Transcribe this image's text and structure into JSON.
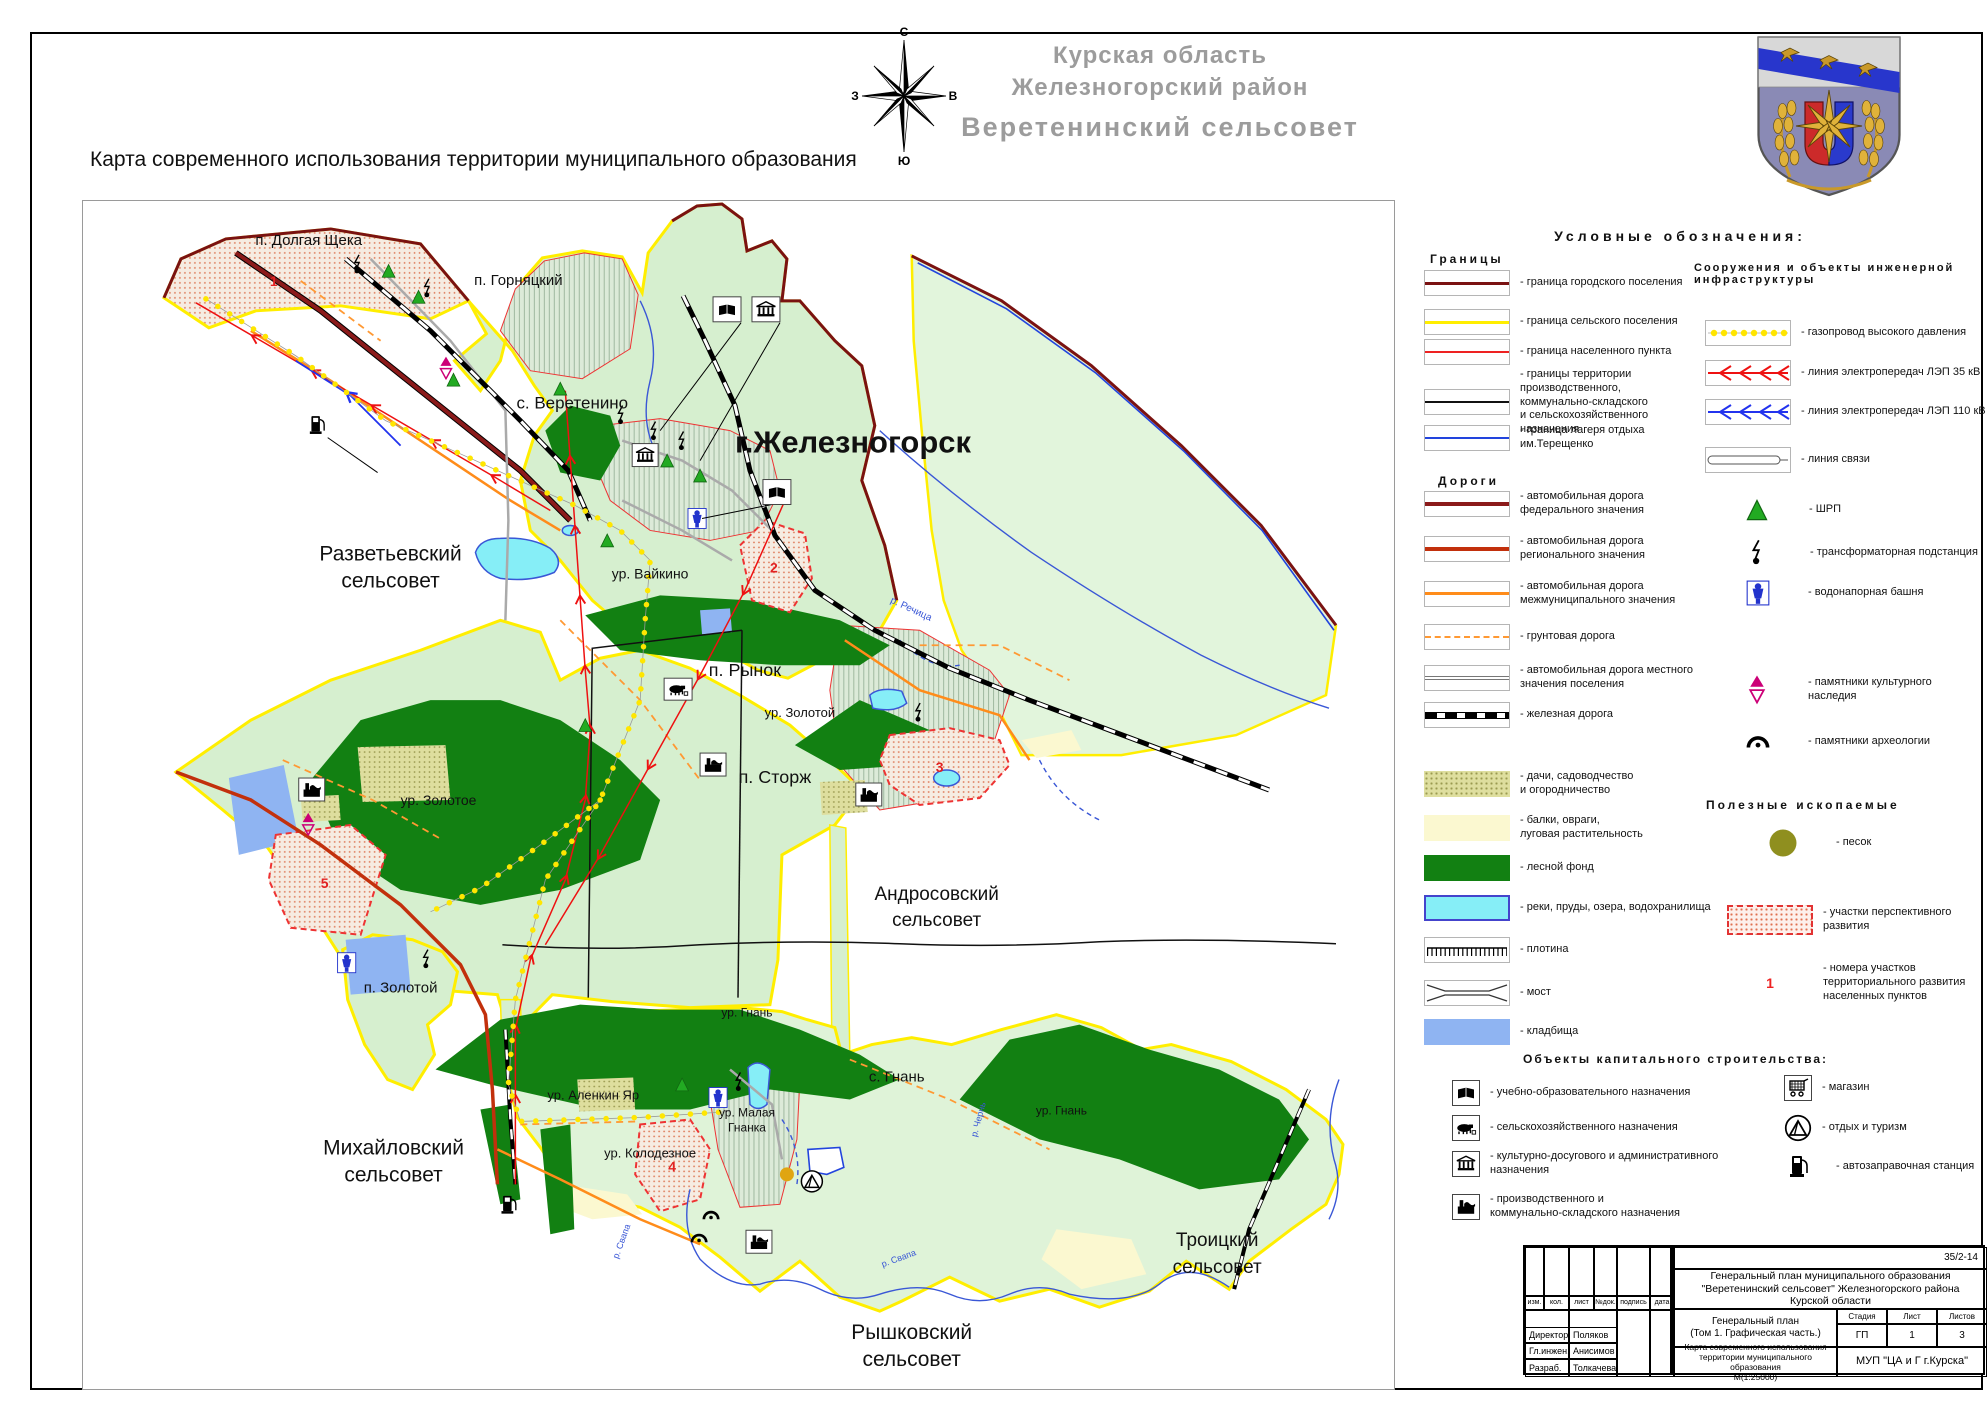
{
  "page": {
    "main_title": "Карта современного использования территории муниципального образования",
    "region_line1": "Курская область",
    "region_line2": "Железногорский  район",
    "region_line3": "Веретенинский  сельсовет",
    "compass": {
      "n": "С",
      "s": "Ю",
      "w": "З",
      "e": "В"
    }
  },
  "map": {
    "labels": {
      "dolgaya": "п. Долгая Щека",
      "gornyatsky": "п. Горняцкий",
      "veretenino": "с. Веретенино",
      "zheleznogorsk": "г.Железногорск",
      "razvet1": "Разветьевский",
      "razvet2": "сельсовет",
      "vaikino": "ур. Вайкино",
      "rynok": "п. Рынок",
      "ur_zolotoy": "ур. Золотой",
      "ur_zolotoye": "ур. Золотое",
      "storzh": "п. Сторж",
      "andros1": "Андросовский",
      "andros2": "сельсовет",
      "p_zolotoy": "п. Золотой",
      "ur_gnan1": "ур. Гнань",
      "alenkin": "ур. Аленкин Яр",
      "s_gnan": "с. Гнань",
      "malaya1": "ур. Малая",
      "malaya2": "Гнанка",
      "ur_gnan2": "ур. Гнань",
      "kolodez": "ур. Колодезное",
      "mikhail1": "Михайловский",
      "mikhail2": "сельсовет",
      "troitsky1": "Троицкий",
      "troitsky2": "сельсовет",
      "ryshkov1": "Рышковский",
      "ryshkov2": "сельсовет",
      "rechitsa": "р. Речица",
      "svapa1": "р. Свапа",
      "svapa2": "р. Свапа",
      "chern": "р. Чернь"
    },
    "zones": {
      "z1": "1",
      "z2": "2",
      "z3": "3",
      "z4": "4",
      "z5": "5"
    }
  },
  "legend": {
    "title": "Условные обозначения:",
    "borders": {
      "header": "Границы",
      "items": [
        "- граница городского поселения",
        "- граница сельского поселения",
        "- граница населенного пункта",
        "- границы территории\nпроизводственного,\nкоммунально-складского\nи сельскохозяйственного\nназначения",
        "- граница лагеря отдыха\nим.Терещенко"
      ]
    },
    "roads": {
      "header": "Дороги",
      "items": [
        "- автомобильная дорога\nфедерального  значения",
        "- автомобильная дорога\nрегионального  значения",
        "- автомобильная дорога\nмежмуниципального  значения",
        "- грунтовая  дорога",
        "- автомобильная дорога местного\nзначения  поселения",
        "- железная дорога"
      ]
    },
    "areas": [
      "-  дачи, садоводчество\nи огородничество",
      "- балки, овраги,\nлуговая растительность",
      "- лесной фонд",
      "- реки, пруды, озера, водохранилища",
      "- плотина",
      "- мост",
      "- кладбища"
    ],
    "infra": {
      "header": "Сооружения и объекты инженерной\nинфраструктуры",
      "gas": "- газопровод высокого давления",
      "lep35": "- линия электропередач  ЛЭП 35 кВ",
      "lep110": "- линия электропередач  ЛЭП 110 кВ",
      "svyaz": "- линия связи",
      "shrp": "- ШРП",
      "transformer": "- трансформаторная подстанция",
      "tower": "- водонапорная башня",
      "monument": "- памятники культурного\nнаследия",
      "arch": "- памятники  археологии"
    },
    "minerals": {
      "header": "Полезные ископаемые",
      "sand": "- песок"
    },
    "development": {
      "area_label": "- участки перспективного\nразвития",
      "num": "1",
      "num_label": "- номера участков\nтерриториального развития\nнаселенных пунктов"
    },
    "capital": {
      "header": "Объекты капитального строительства:",
      "col1": [
        "- учебно-образовательного назначения",
        "- сельскохозяйственного назначения",
        "- культурно-досугового и административного\nназначения",
        "- производственного и\nкоммунально-складского  назначения"
      ],
      "col2": [
        "- магазин",
        "- отдых и туризм",
        "- автозаправочная  станция"
      ]
    }
  },
  "title_block": {
    "code": "35/2-14",
    "project1": "Генеральный план муниципального  образования",
    "project2": "\"Веретенинский  сельсовет\" Железногорского  района",
    "project3": "Курской области",
    "doc1": "Генеральный план",
    "doc2": "(Том 1. Графическая часть.)",
    "stage_h": "Стадия",
    "sheet_h": "Лист",
    "sheets_h": "Листов",
    "stage": "ГП",
    "sheet": "1",
    "sheets": "3",
    "map_title": "Карта  современного использования\nтерритории муниципального образования\nМ(1:25000)",
    "org": "МУП \"ЦА и Г г.Курска\"",
    "cols": [
      "изм.",
      "кол.",
      "лист",
      "№док.",
      "подпись",
      "дата"
    ],
    "roles": [
      [
        "Директор",
        "Поляков"
      ],
      [
        "Гл.инжен.",
        "Анисимов"
      ],
      [
        "Разраб.",
        "Толкачева"
      ]
    ]
  }
}
